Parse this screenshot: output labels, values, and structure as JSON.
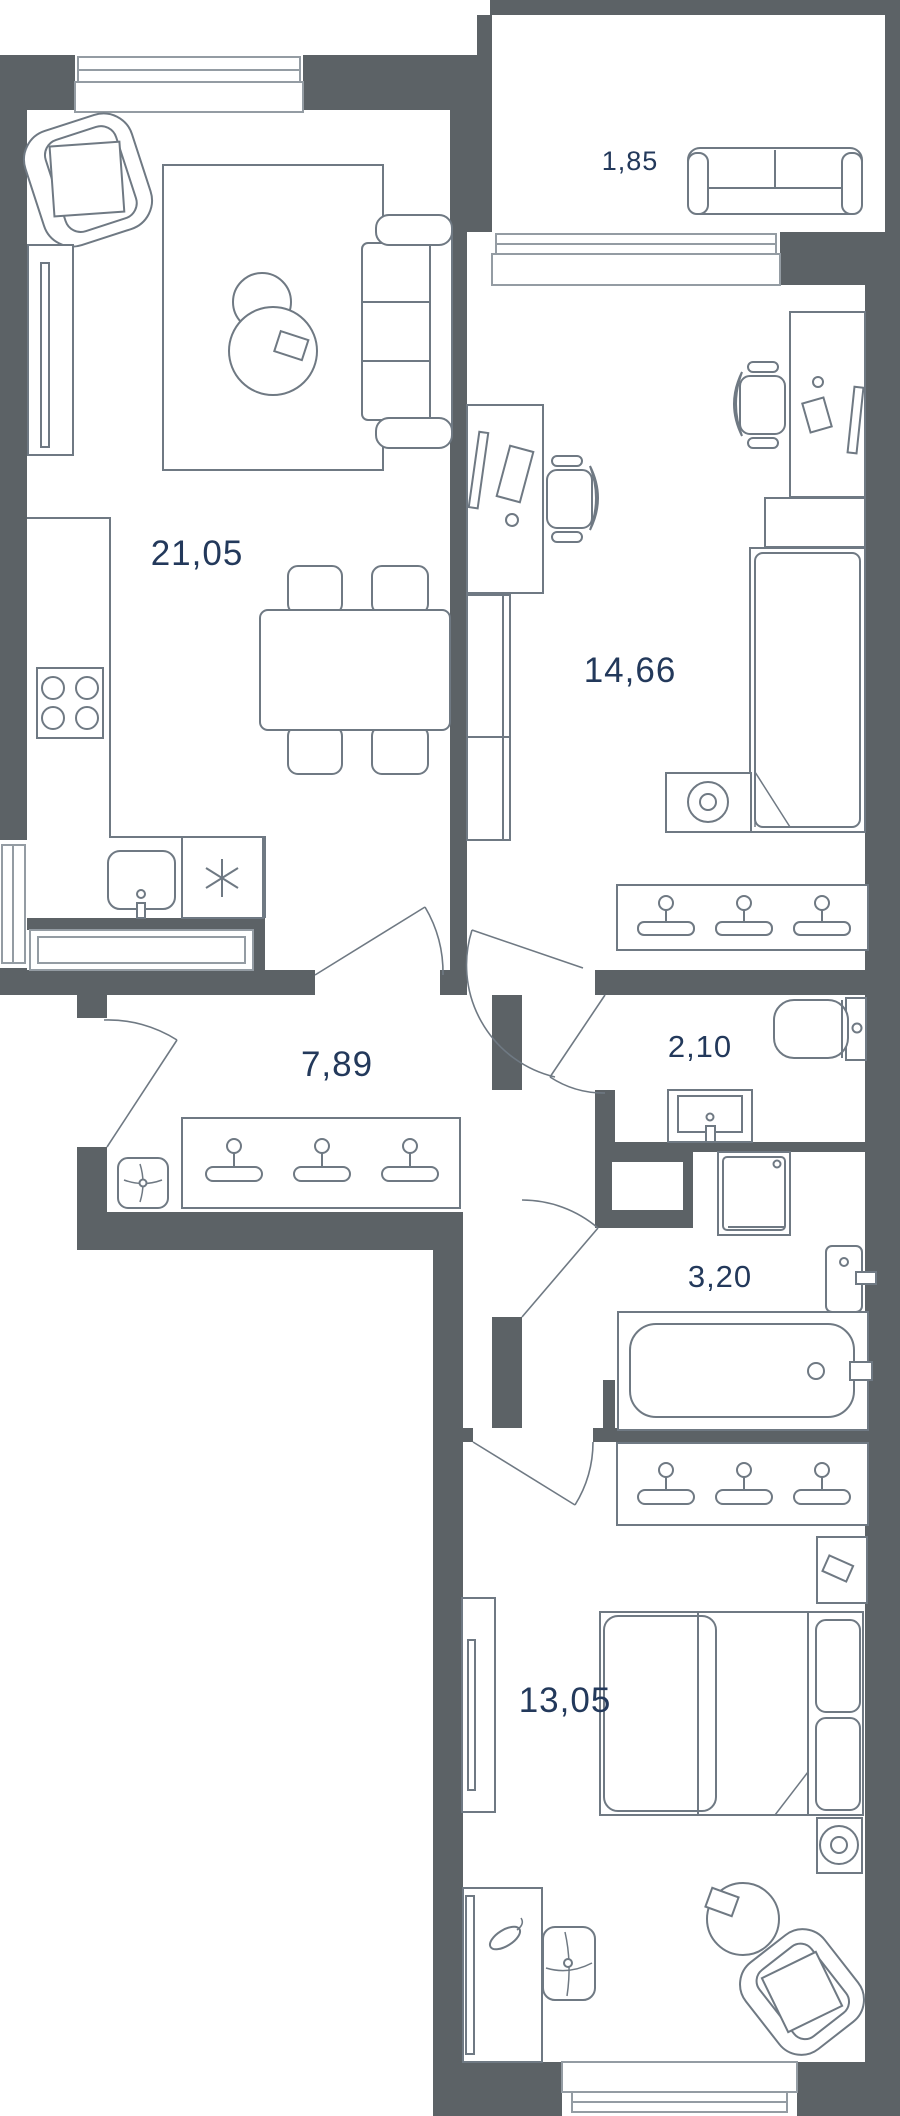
{
  "plan": {
    "type": "apartment-floor-plan",
    "units": "square-meters-implied",
    "rooms": [
      {
        "id": "living-kitchen",
        "area": "21,05"
      },
      {
        "id": "balcony",
        "area": "1,85"
      },
      {
        "id": "bedroom-office",
        "area": "14,66"
      },
      {
        "id": "hallway",
        "area": "7,89"
      },
      {
        "id": "toilet",
        "area": "2,10"
      },
      {
        "id": "bathroom",
        "area": "3,20"
      },
      {
        "id": "bedroom",
        "area": "13,05"
      }
    ],
    "furniture": {
      "living-kitchen": [
        "armchair",
        "tv-console",
        "rug",
        "coffee-table-small",
        "coffee-table-large",
        "sofa",
        "dining-table",
        "dining-chairs",
        "kitchen-counter",
        "stove",
        "kitchen-sink",
        "fridge"
      ],
      "balcony": [
        "loveseat"
      ],
      "bedroom-office": [
        "desk-left",
        "office-chair-left",
        "wardrobe",
        "desk-right",
        "office-chair-right",
        "single-bed",
        "speaker-table",
        "hanger-rack"
      ],
      "hallway": [
        "pouf",
        "hanger-rack"
      ],
      "toilet": [
        "toilet-bowl",
        "washbasin"
      ],
      "bathroom": [
        "washing-machine",
        "vent-shaft",
        "towel-rail",
        "bathtub"
      ],
      "bedroom": [
        "tv-console",
        "hanger-rack",
        "corner-shelf",
        "double-bed",
        "speaker-table",
        "round-rug",
        "armchair",
        "desk",
        "swivel-chair"
      ]
    },
    "colors": {
      "wall": "#5c6266",
      "furniture_line": "#6f7983",
      "window_line": "#949ca3",
      "label_text": "#23395b",
      "background": "#ffffff"
    }
  }
}
